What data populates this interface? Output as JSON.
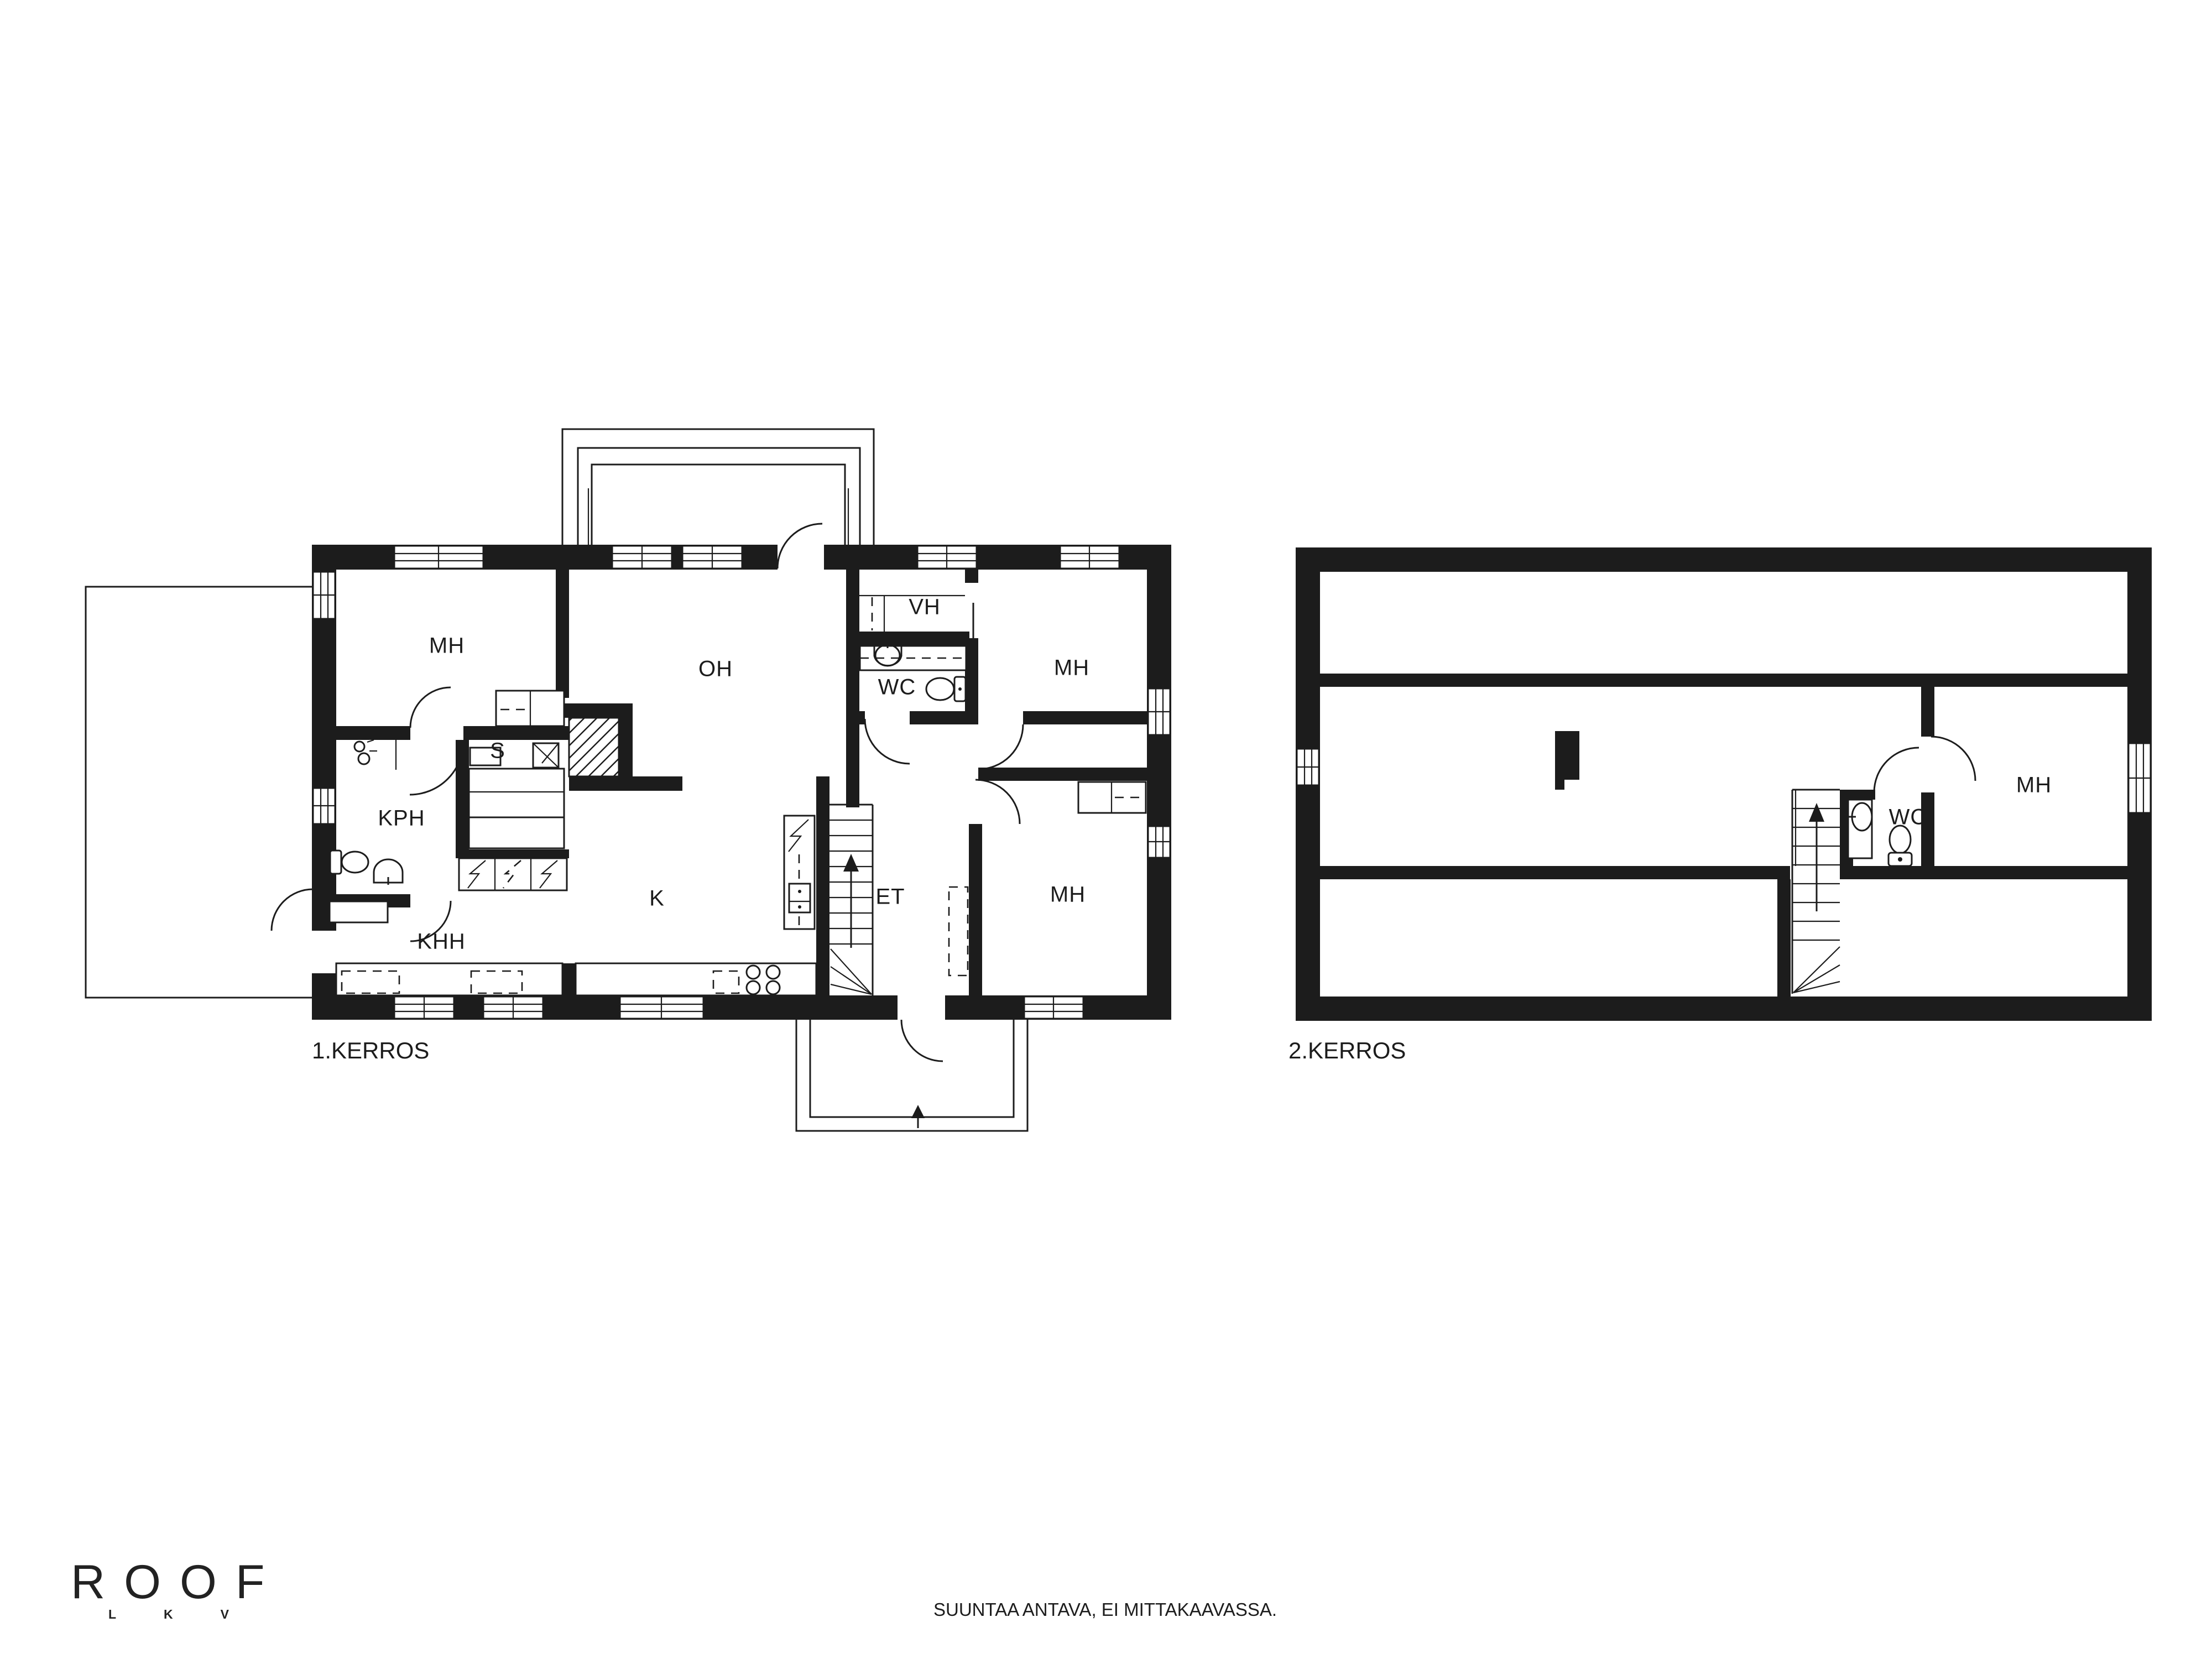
{
  "drawing": {
    "ink_color": "#1c1c1c",
    "background_color": "#ffffff"
  },
  "floors": {
    "floor1": {
      "title": "1.KERROS",
      "rooms": {
        "mh1": "MH",
        "oh": "OH",
        "vh": "VH",
        "wc": "WC",
        "mh3": "MH",
        "kph": "KPH",
        "s": "S",
        "khh": "KHH",
        "k": "K",
        "et": "ET",
        "mh2": "MH"
      }
    },
    "floor2": {
      "title": "2.KERROS",
      "rooms": {
        "mh": "MH",
        "wc": "WC"
      }
    }
  },
  "branding": {
    "logo_text": "ROOF",
    "logo_sub": "LKV"
  },
  "footer": {
    "disclaimer": "SUUNTAA ANTAVA, EI MITTAKAAVASSA."
  }
}
